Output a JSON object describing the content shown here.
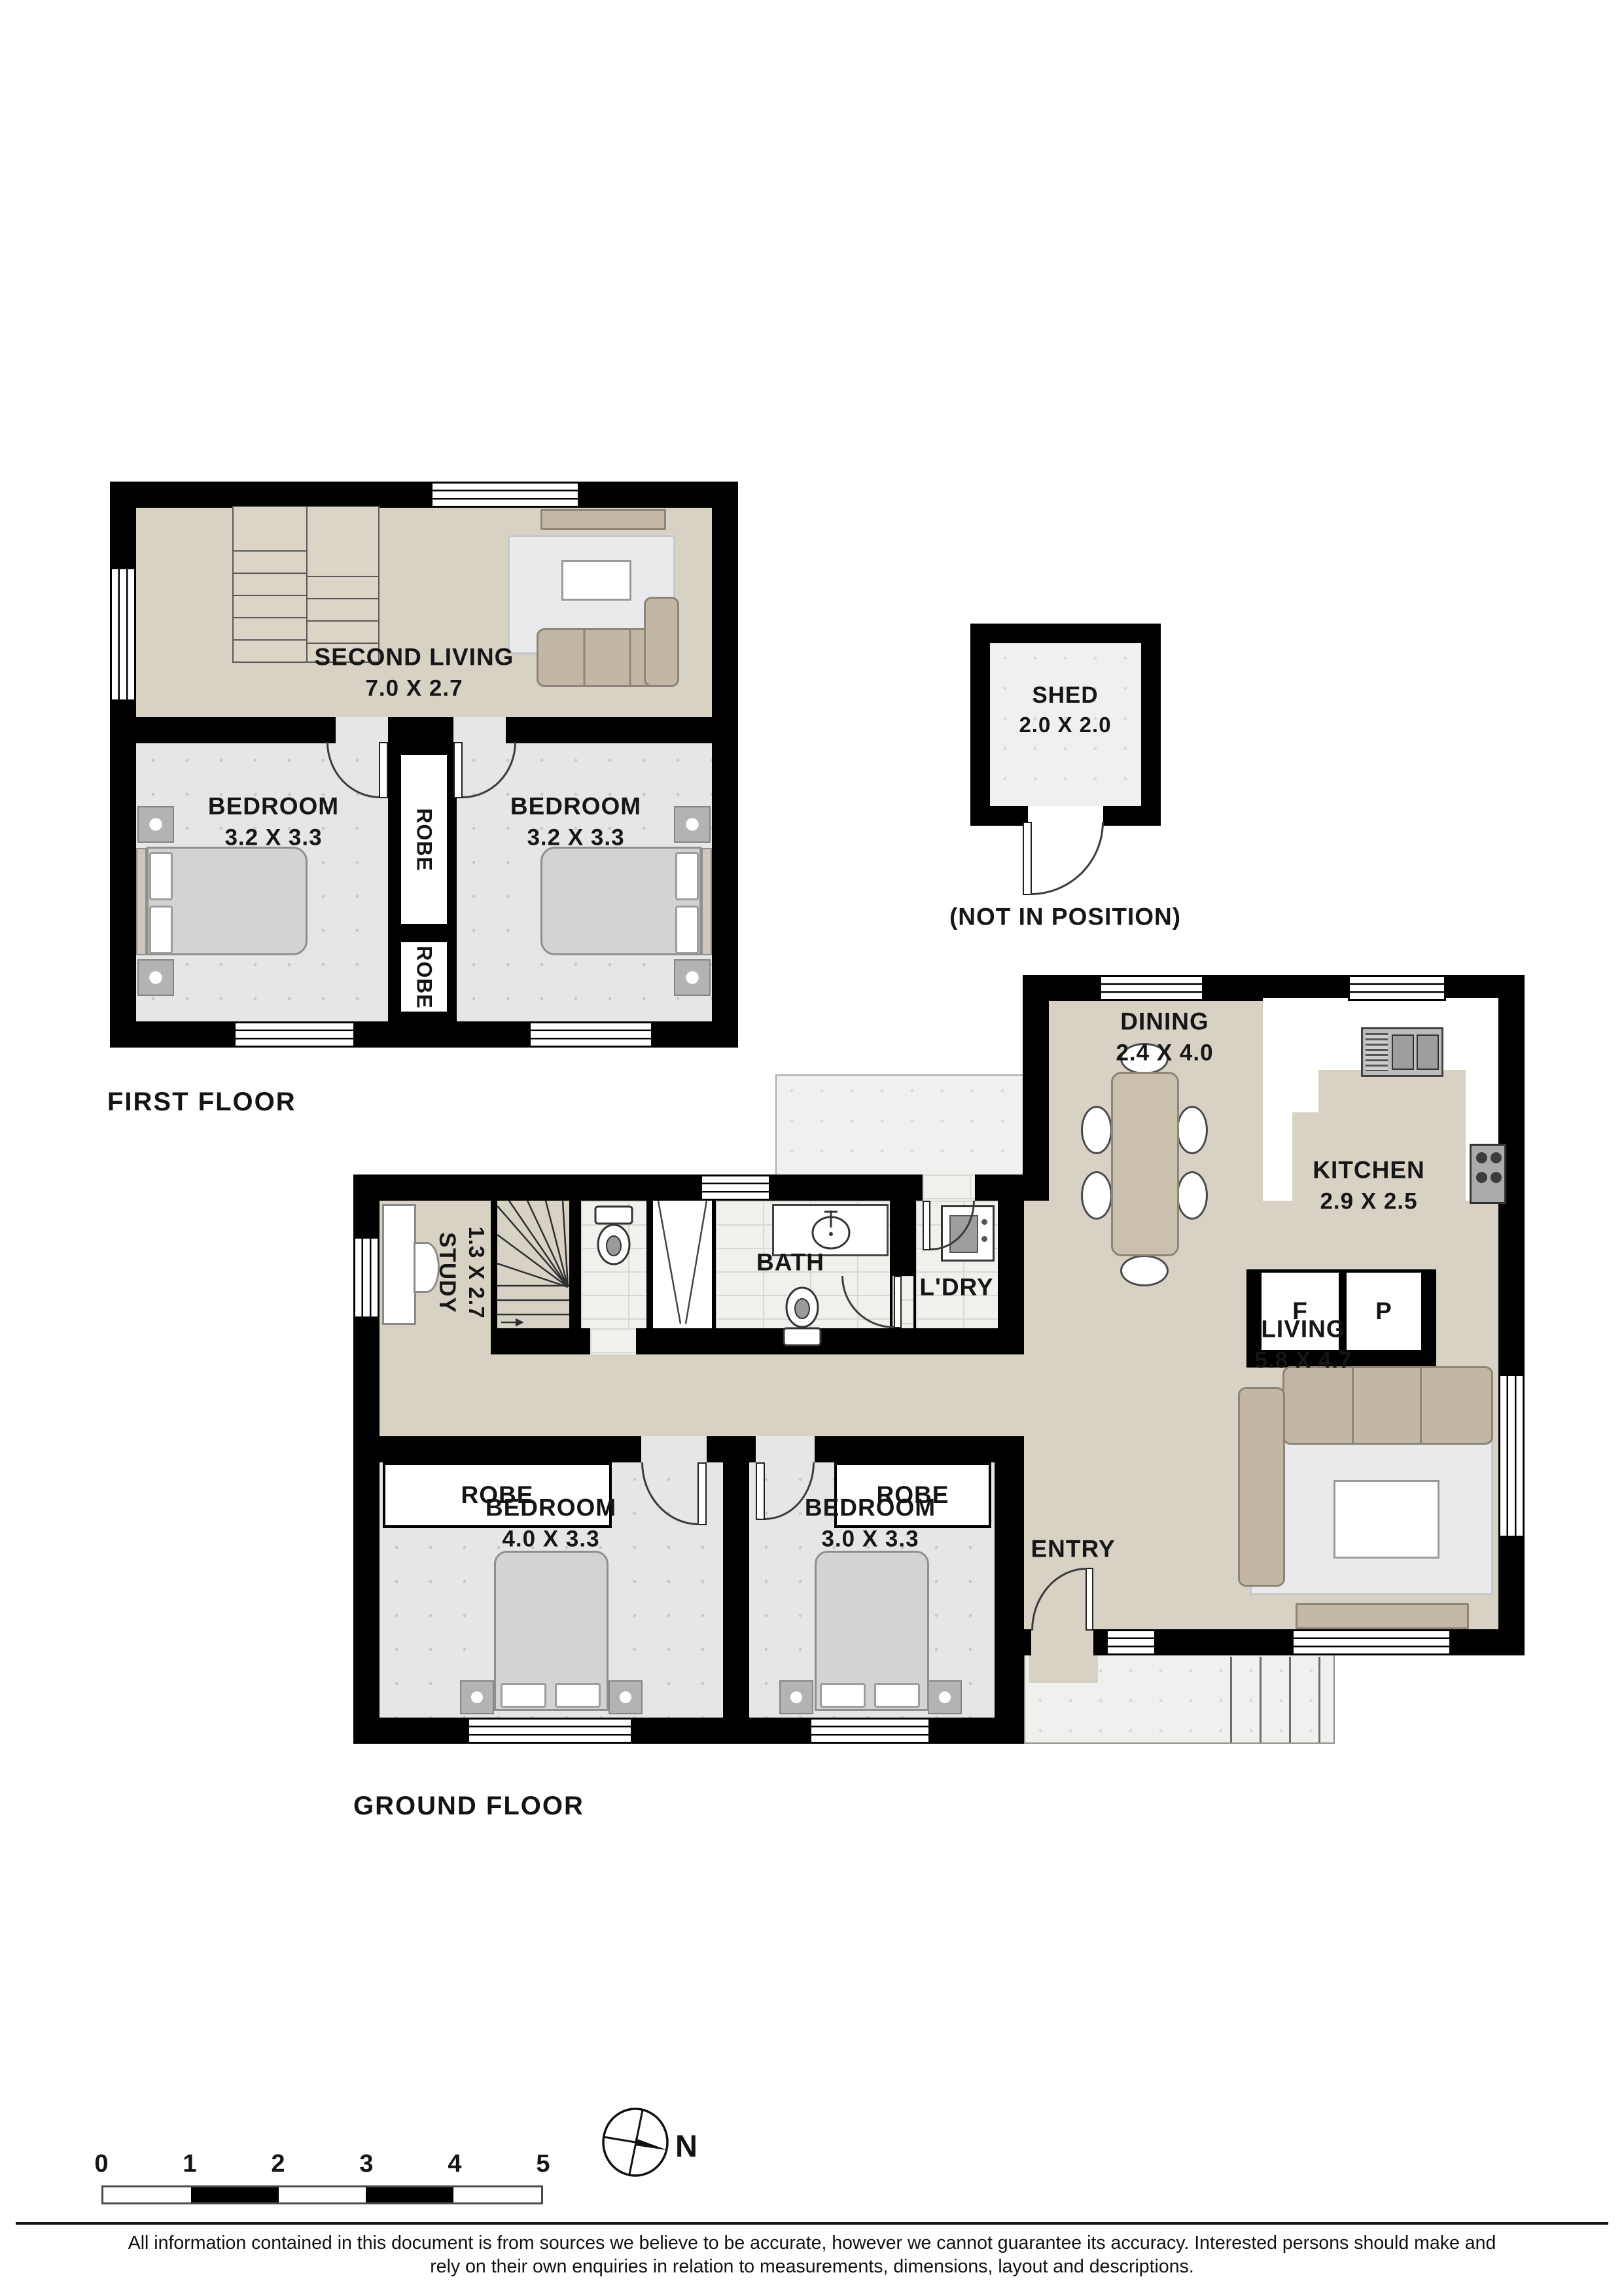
{
  "first_floor": {
    "title": "FIRST FLOOR",
    "second_living": {
      "name": "SECOND LIVING",
      "dims": "7.0 X 2.7"
    },
    "bedroom_left": {
      "name": "BEDROOM",
      "dims": "3.2 X 3.3"
    },
    "bedroom_right": {
      "name": "BEDROOM",
      "dims": "3.2 X 3.3"
    },
    "robe_upper": "ROBE",
    "robe_lower": "ROBE"
  },
  "shed": {
    "name": "SHED",
    "dims": "2.0 X 2.0",
    "note": "(NOT IN POSITION)"
  },
  "ground_floor": {
    "title": "GROUND FLOOR",
    "dining": {
      "name": "DINING",
      "dims": "2.4 X 4.0"
    },
    "kitchen": {
      "name": "KITCHEN",
      "dims": "2.9 X 2.5",
      "fridge_label": "F",
      "pantry_label": "P"
    },
    "living": {
      "name": "LIVING",
      "dims": "5.8 X 4.7"
    },
    "study": {
      "name": "STUDY",
      "dims": "1.3 X 2.7"
    },
    "bath": {
      "name": "BATH"
    },
    "laundry": {
      "name": "L'DRY"
    },
    "entry": {
      "name": "ENTRY"
    },
    "bedroom_left": {
      "name": "BEDROOM",
      "dims": "4.0 X 3.3"
    },
    "bedroom_right": {
      "name": "BEDROOM",
      "dims": "3.0 X 3.3"
    },
    "robe_left": "ROBE",
    "robe_right": "ROBE"
  },
  "scale_bar": {
    "ticks": [
      "0",
      "1",
      "2",
      "3",
      "4",
      "5"
    ]
  },
  "compass": {
    "north_label": "N"
  },
  "disclaimer": {
    "line1": "All information contained in this document is from sources we believe to be accurate, however we cannot guarantee its accuracy. Interested persons should make and",
    "line2": "rely on their own enquiries in relation to measurements, dimensions, layout and descriptions."
  },
  "colors": {
    "wall": "#000000",
    "floor_beige": "#d8d2c5",
    "floor_gray": "#e6e6e5",
    "floor_tile": "#eff1ed",
    "furniture_tan": "#c4b9a6",
    "rug": "#e8eaec"
  }
}
